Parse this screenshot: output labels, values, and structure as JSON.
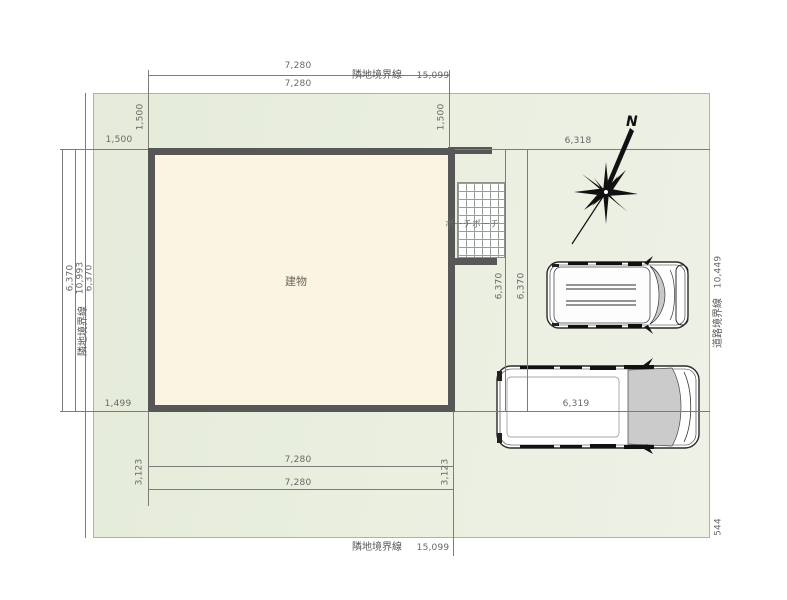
{
  "site_plan": {
    "building_label": "建物",
    "porch_label": "ポーチポーチ",
    "compass": {
      "icon": "north-arrow-star",
      "label": "N"
    },
    "vehicles": [
      "minivan-top-view",
      "van-top-view"
    ],
    "boundaries": {
      "top": {
        "name": "隣地境界線",
        "length": "15,099"
      },
      "bottom": {
        "name": "隣地境界線",
        "length": "15,099"
      },
      "left": {
        "name": "隣地境界線",
        "length": "10,993"
      },
      "right": {
        "name": "道路境界線",
        "length": "10,449",
        "extra_segment": "544"
      }
    },
    "dimensions": {
      "building_width_top_1": "7,280",
      "building_width_top_2": "7,280",
      "building_width_bottom_1": "7,280",
      "building_width_bottom_2": "7,280",
      "building_depth_left_1": "6,370",
      "building_depth_left_2": "6,370",
      "building_depth_right_1": "6,370",
      "building_depth_right_2": "6,370",
      "setback_top_left": "1,500",
      "setback_top_right": "1,500",
      "setback_left_top": "1,500",
      "setback_left_bottom": "1,499",
      "parking_width_top": "6,318",
      "parking_width_bottom": "6,319",
      "offset_bottom_left": "3,123",
      "offset_bottom_right": "3,123"
    },
    "colors": {
      "site_fill": "#e9eee0",
      "building_fill": "#fbf4e3",
      "wall": "#575757",
      "dimension_line": "#7c7c7c",
      "windshield": "#c9c9c9"
    }
  }
}
